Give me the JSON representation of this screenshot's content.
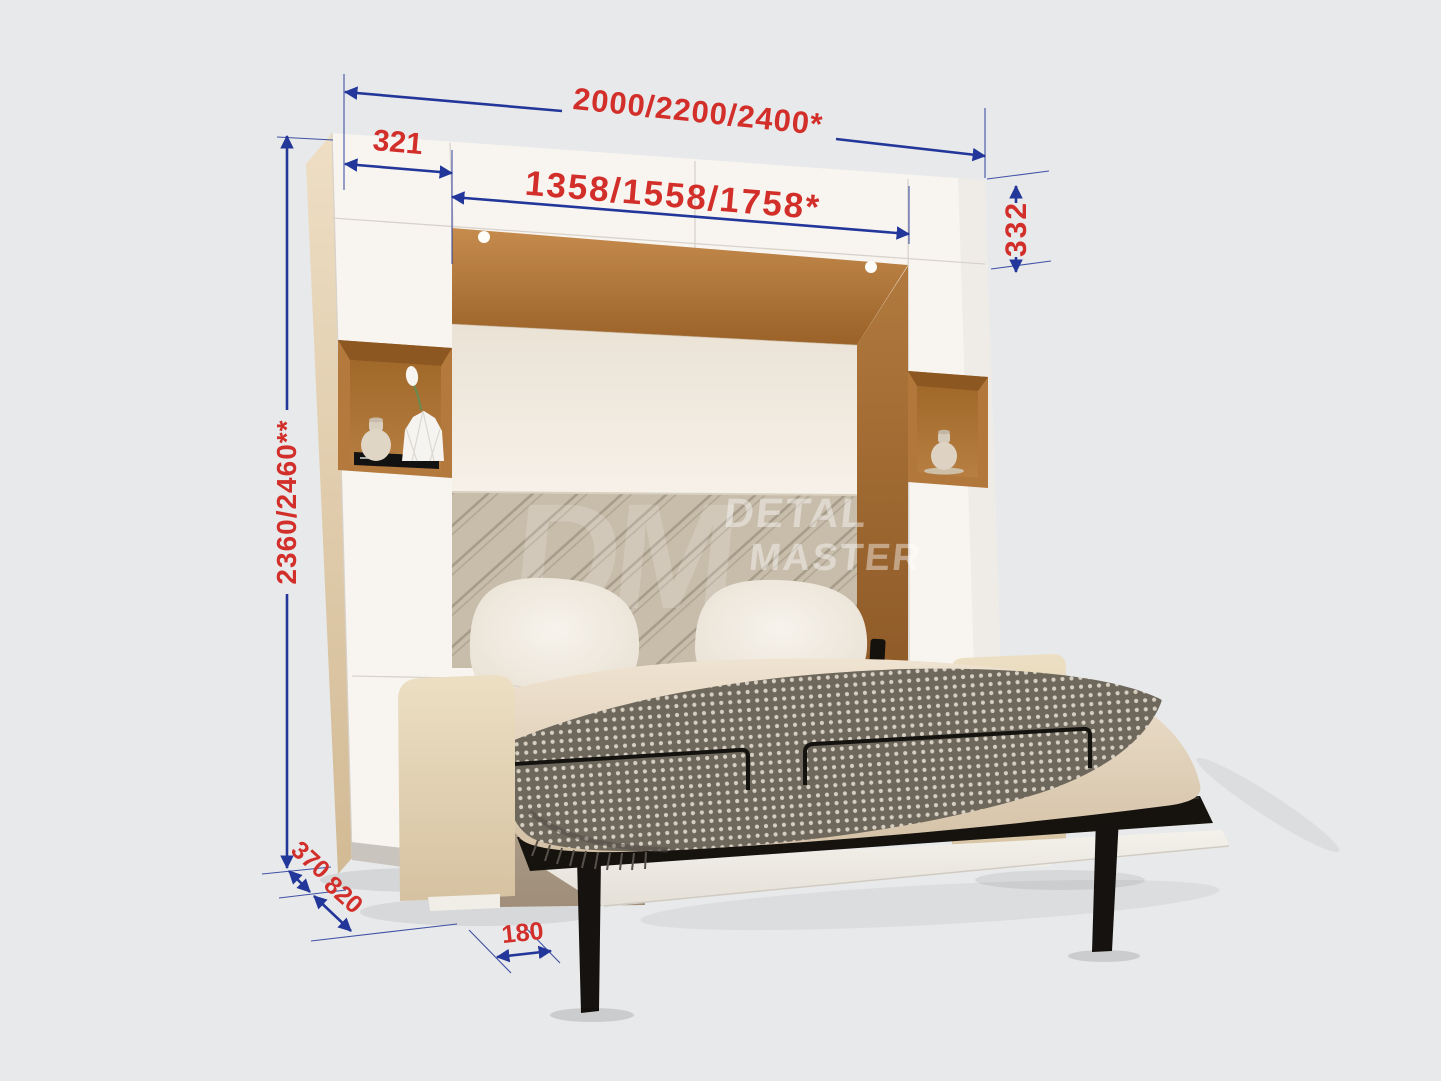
{
  "scene": {
    "description": "Dimensional diagram of a wall bed unit with sofa, open shelves and top cabinets"
  },
  "colors": {
    "background": "#e8e9ea",
    "dimension_line": "#23379a",
    "dimension_text": "#d22f2b",
    "cabinet_white": "#f8f5f1",
    "wood": "#b1793d"
  },
  "dimensions": {
    "overall_width": "2000/2200/2400*",
    "inner_width": "1358/1558/1758*",
    "left_cabinet_width": "321",
    "top_cabinet_height": "332",
    "overall_height": "2360/2460**",
    "cabinet_depth": "370",
    "sofa_depth": "820",
    "leg_offset": "180"
  },
  "watermark": {
    "monogram": "DM",
    "line1": "DETAL",
    "line2": "MASTER"
  }
}
